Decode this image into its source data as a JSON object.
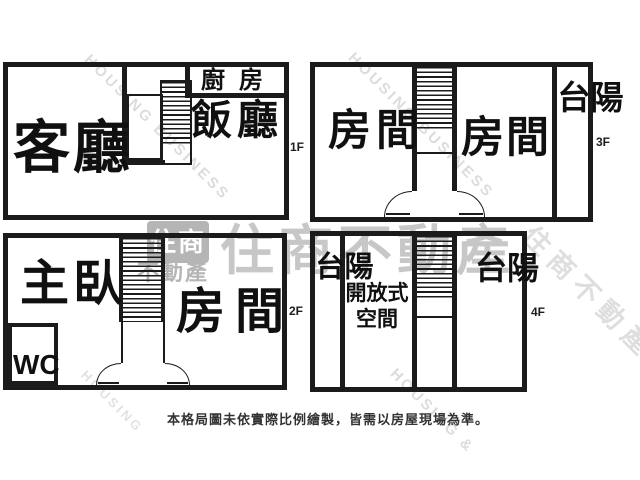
{
  "watermark": {
    "brand": "住商不動產",
    "brand_en": "HOUSING BUSINESS",
    "brand_en_short": "HOUSING &",
    "brand_en_word": "HOUSING",
    "logo_top": "住商",
    "logo_bottom": "不動產",
    "brand_color": "#c7c7c7",
    "diag_color": "#dcdcdc",
    "logo_color": "#b5b5b5"
  },
  "line_color": "#1b1b1b",
  "floors": {
    "f1": {
      "label": "1F",
      "living": "客廳",
      "dining": "飯廳",
      "kitchen": "廚房"
    },
    "f3": {
      "label": "3F",
      "room_left": "房間",
      "room_right": "房間",
      "balcony": "陽台"
    },
    "f2": {
      "label": "2F",
      "master": "主臥",
      "wc": "WC",
      "room": "房間"
    },
    "f4": {
      "label": "4F",
      "balcony_left": "陽台",
      "open_space": "開放式空間",
      "balcony_right": "陽台"
    }
  },
  "footer": {
    "disclaimer": "本格局圖未依實際比例繪製，皆需以房屋現場為準。"
  }
}
